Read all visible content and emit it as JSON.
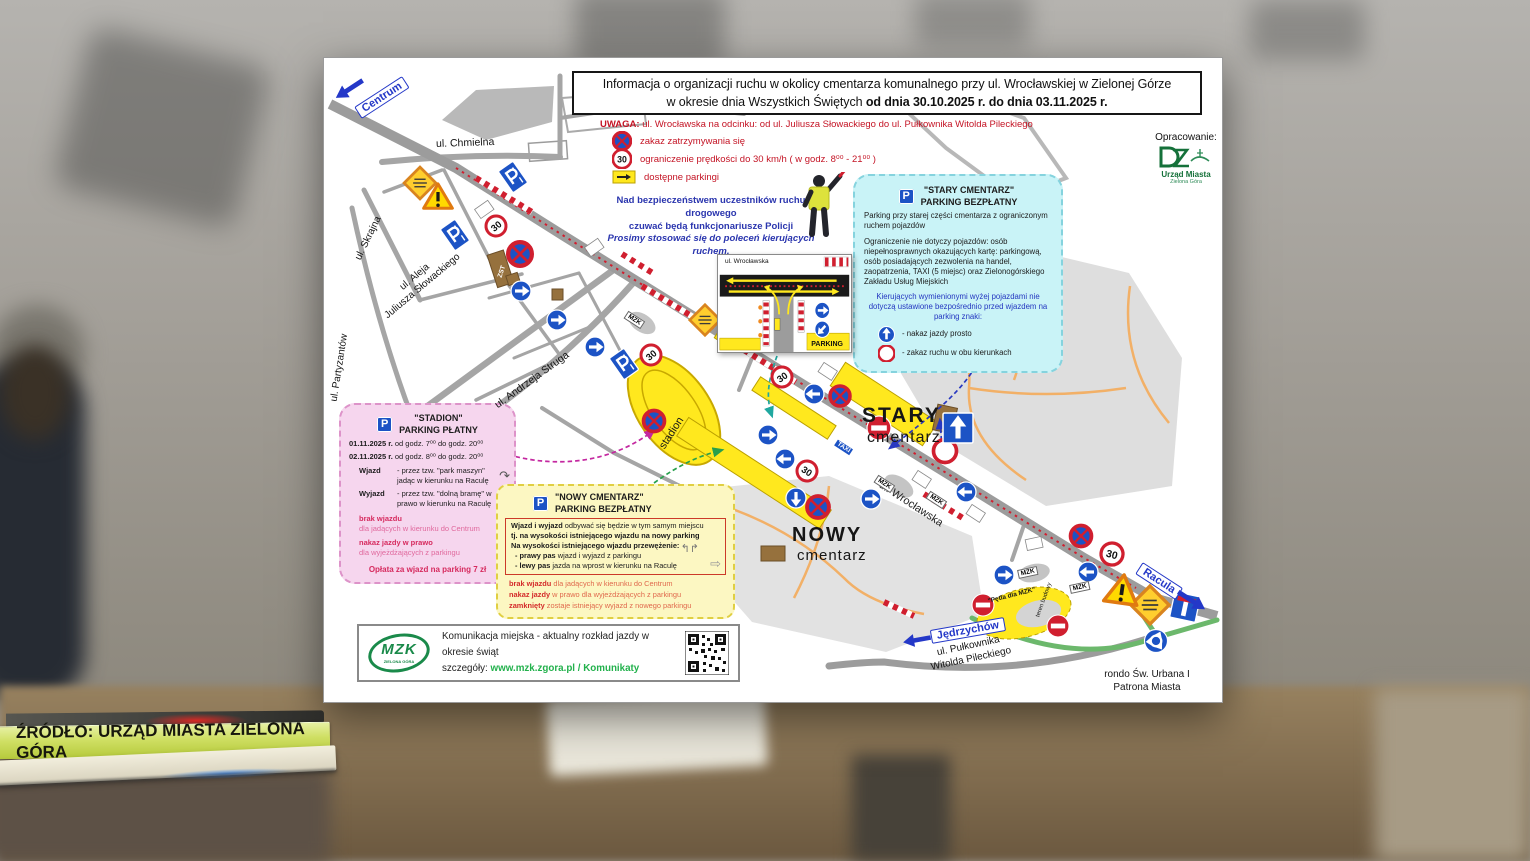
{
  "colors": {
    "accent_red": "#c41425",
    "sign_blue": "#1c53c5",
    "box_cyan": "#c9f3f7",
    "box_pink": "#f6d6ee",
    "box_yellow": "#fcf7c2",
    "banner_lime": "#c3d44f",
    "mzk_green": "#1a8a4a"
  },
  "source_banner": {
    "text": "ŹRÓDŁO: URZĄD MIASTA ZIELONA GÓRA"
  },
  "map": {
    "title": {
      "line1": "Informacja o organizacji ruchu w okolicy cmentarza komunalnego przy ul. Wrocławskiej w Zielonej Górze",
      "line2_normal": "w okresie dnia Wszystkich Świętych ",
      "line2_bold": "od dnia 30.10.2025 r. do dnia 03.11.2025 r."
    },
    "uwaga": {
      "label": "UWAGA:",
      "heading": "ul. Wrocławska na odcinku:  od ul. Juliusza Słowackiego do ul. Pułkownika Witolda Pileckiego",
      "item_stopping": "zakaz zatrzymywania się",
      "item_speed": "ograniczenie prędkości do 30 km/h ( w godz. 8⁰⁰ - 21⁰⁰ )",
      "item_parking": "dostępne parkingi"
    },
    "police": {
      "line1": "Nad bezpieczeństwem uczestników ruchu drogowego",
      "line2": "czuwać będą funkcjonariusze Policji",
      "line3": "Prosimy stosować się do poleceń kierujących ruchem."
    },
    "credit": {
      "label": "Opracowanie:",
      "org1": "Urząd Miasta",
      "org2": "Zielona Góra"
    },
    "stary_box": {
      "title1": "\"STARY CMENTARZ\"",
      "title2": "PARKING BEZPŁATNY",
      "para1": "Parking przy starej części cmentarza z ograniczonym ruchem pojazdów",
      "para2": "Ograniczenie nie dotyczy pojazdów: osób niepełnosprawnych okazujących kartę: parkingową, osób posiadających zezwolenia na handel, zaopatrzenia, TAXI (5 miejsc) oraz Zielonogórskiego Zakładu Usług Miejskich",
      "para3": "Kierujących wymienionymi wyżej pojazdami nie dotyczą ustawione bezpośrednio przed wjazdem na parking znaki:",
      "legend1": "- nakaz jazdy prosto",
      "legend2": "- zakaz ruchu w obu kierunkach"
    },
    "stadion_box": {
      "title1": "\"STADION\"",
      "title2": "PARKING PŁATNY",
      "date1_bold": "01.11.2025 r.",
      "date1_rest": " od godz. 7⁰⁰  do godz. 20⁰⁰",
      "date2_bold": "02.11.2025 r.",
      "date2_rest": " od godz. 8⁰⁰  do godz. 20⁰⁰",
      "wjazd_label": "Wjazd",
      "wjazd_text": "- przez tzw. \"park maszyn\" jadąc w kierunku na Raculę",
      "wyjazd_label": "Wyjazd",
      "wyjazd_text": "- przez tzw. \"dolną bramę\" w prawo w kierunku na Raculę",
      "warn1_bold": "brak wjazdu",
      "warn1_rest": "dla jadących w kierunku do Centrum",
      "warn2_bold": "nakaz jazdy w prawo",
      "warn2_rest": "dla wyjeżdżających z parkingu",
      "fee": "Opłata za wjazd na parking  7 zł"
    },
    "nowy_box": {
      "title1": "\"NOWY CMENTARZ\"",
      "title2": "PARKING BEZPŁATNY",
      "in1_bold": "Wjazd i wyjazd",
      "in1_rest": " odbywać się będzie w tym samym miejscu",
      "in2": "tj. na wysokości istniejącego wjazdu na nowy parking",
      "in3": "Na wysokości istniejącego wjazdu przewężenie:",
      "lane1_bold": "- prawy pas",
      "lane1_rest": "   wjazd i wyjazd z parkingu",
      "lane2_bold": "- lewy pas",
      "lane2_rest": "   jazda na wprost w kierunku na Raculę",
      "warn1_bold": "brak wjazdu",
      "warn1_rest": " dla jadących w kierunku do Centrum",
      "warn2_bold": "nakaz jazdy",
      "warn2_rest": " w prawo dla wyjeżdżających z parkingu",
      "warn3_bold": "zamknięty",
      "warn3_rest": " zostaje istniejący wyjazd z nowego parkingu"
    },
    "mzk_box": {
      "logo": "MZK",
      "logo_sub": "ZIELONA GÓRA",
      "line1": "Komunikacja miejska - aktualny rozkład jazdy w okresie świąt",
      "line2_label": "szczegóły: ",
      "line2_link": "www.mzk.zgora.pl / Komunikaty"
    },
    "labels": {
      "centrum": "Centrum",
      "chmielna": "ul. Chmielna",
      "skrajna": "ul. Skrajna",
      "partyzantow": "ul. Partyzantów",
      "aleja": "ul. Aleja",
      "slowackiego": "Juliusza Słowackiego",
      "struga": "ul. Andrzeja Struga",
      "wroclawska": "ul. Wrocławska",
      "stadion": "stadion",
      "stary": "STARY",
      "nowy": "NOWY",
      "cmentarz": "cmentarz",
      "racula": "Racula",
      "jedrzychow": "Jędrzychów",
      "pileckiego1": "ul. Pułkownika",
      "pileckiego2": "Witolda Pileckiego",
      "rondo1": "rondo Św. Urbana I",
      "rondo2": "Patrona Miasta",
      "zst": "ZST",
      "taxi": "TAXI",
      "mzk": "MZK",
      "petla": "\"Pętla dla MZK\"",
      "teren": "teren budowy",
      "speed30": "30",
      "p": "P",
      "inset_street": "ul. Wrocławska",
      "inset_parking": "PARKING"
    }
  }
}
